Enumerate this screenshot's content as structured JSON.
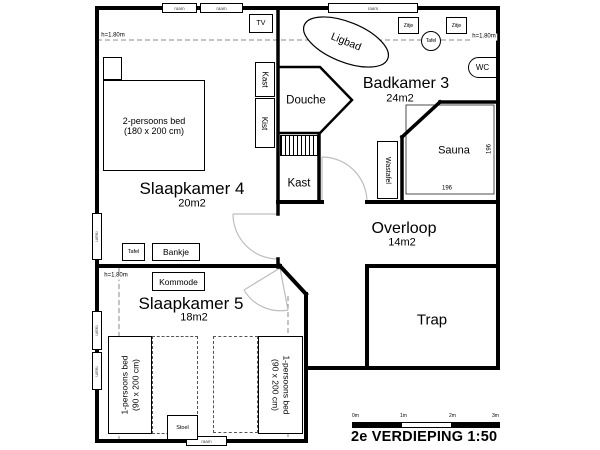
{
  "plan": {
    "title": "2e VERDIEPING 1:50",
    "scale_labels": [
      "0m",
      "1m",
      "2m",
      "3m"
    ],
    "height_label": "h=1.80m",
    "window_label": "raam"
  },
  "rooms": {
    "slaapkamer4": {
      "name": "Slaapkamer 4",
      "area": "20m2"
    },
    "slaapkamer5": {
      "name": "Slaapkamer 5",
      "area": "18m2"
    },
    "badkamer3": {
      "name": "Badkamer 3",
      "area": "24m2"
    },
    "overloop": {
      "name": "Overloop",
      "area": "14m2"
    },
    "trap": {
      "name": "Trap"
    },
    "douche": {
      "name": "Douche"
    },
    "kast": {
      "name": "Kast"
    },
    "sauna": {
      "name": "Sauna",
      "width_cm": "196",
      "depth_cm": "196"
    }
  },
  "furniture": {
    "tv": "TV",
    "kast": "Kast",
    "kist": "Kist",
    "tafel": "Tafel",
    "bankje": "Bankje",
    "kommode": "Kommode",
    "stoel": "Stoel",
    "ligbad": "Ligbad",
    "zitje": "Zitje",
    "tafel_rond": "Tafel",
    "wc": "WC",
    "wastafel": "Wastafel",
    "bed_2p_line1": "2-persoons bed",
    "bed_2p_line2": "(180 x 200 cm)",
    "bed_1p_line1": "1-persoons bed",
    "bed_1p_line2": "(90 x 200 cm)"
  }
}
